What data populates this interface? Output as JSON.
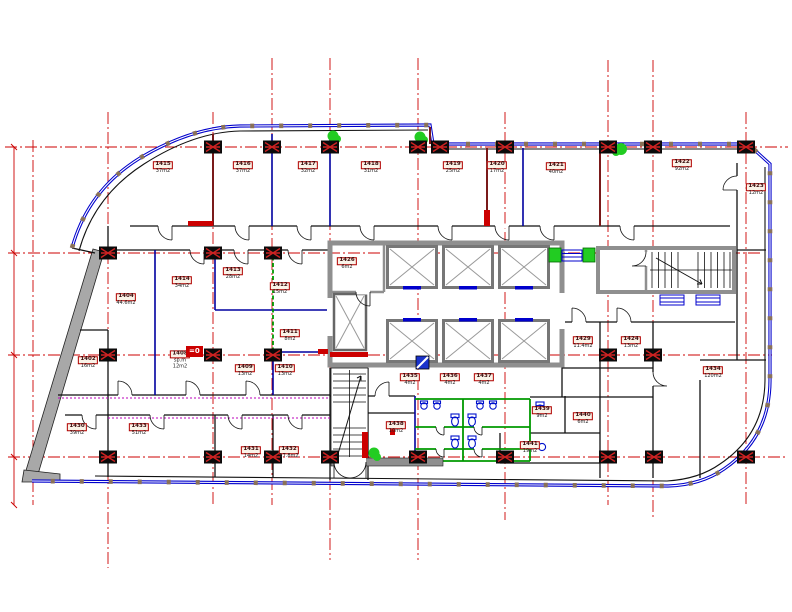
{
  "drawing": {
    "type": "architectural-floor-plan",
    "colors": {
      "grid_axis": "#cc0000",
      "curtain_wall": "#0000cc",
      "partition_blue": "#0000a0",
      "partition_dark_red": "#7a1a1a",
      "sanitary_green": "#009900",
      "concrete_gray": "#a8a8a8",
      "core_gray": "#8f8f8f",
      "mullion_brown": "#8a7257",
      "fixture_blue": "#0011cc",
      "plant_green": "#22cc22",
      "label_red": "#b00000"
    },
    "level_marker": {
      "text": "=0"
    },
    "dim_labels": [
      {
        "text": "8 400",
        "x": 7,
        "y": 232
      },
      {
        "text": "8 400",
        "x": 7,
        "y": 327
      },
      {
        "text": "8 400",
        "x": 7,
        "y": 437
      },
      {
        "text": "4 050",
        "x": 7,
        "y": 502
      }
    ],
    "rooms": [
      {
        "id": "1415",
        "area": "37m2",
        "x": 163,
        "y": 168
      },
      {
        "id": "1416",
        "area": "37m2",
        "x": 243,
        "y": 168
      },
      {
        "id": "1417",
        "area": "32m2",
        "x": 308,
        "y": 168
      },
      {
        "id": "1418",
        "area": "31m2",
        "x": 371,
        "y": 168
      },
      {
        "id": "1419",
        "area": "25m2",
        "x": 453,
        "y": 168
      },
      {
        "id": "1420",
        "area": "17m2",
        "x": 497,
        "y": 168
      },
      {
        "id": "1421",
        "area": "40m2",
        "x": 556,
        "y": 169
      },
      {
        "id": "1422",
        "area": "92m2",
        "x": 682,
        "y": 166
      },
      {
        "id": "1423",
        "area": "12m2",
        "x": 756,
        "y": 190
      },
      {
        "id": "1404",
        "area": "44.6m2",
        "x": 126,
        "y": 300
      },
      {
        "id": "1414",
        "area": "34m2",
        "x": 182,
        "y": 283
      },
      {
        "id": "1413",
        "area": "28m2",
        "x": 233,
        "y": 274
      },
      {
        "id": "1412",
        "area": "15m2",
        "x": 280,
        "y": 289
      },
      {
        "id": "1411",
        "area": "8m2",
        "x": 290,
        "y": 336
      },
      {
        "id": "1402",
        "area": "16m2",
        "x": 88,
        "y": 363
      },
      {
        "id": "1408",
        "sub": "sp.m",
        "area": "12m2",
        "x": 180,
        "y": 360
      },
      {
        "id": "1409",
        "area": "13m2",
        "x": 245,
        "y": 371
      },
      {
        "id": "1410",
        "area": "13m2",
        "x": 285,
        "y": 371
      },
      {
        "id": "1426",
        "area": "6m2",
        "x": 347,
        "y": 264
      },
      {
        "id": "1435",
        "area": "4m2",
        "x": 410,
        "y": 380
      },
      {
        "id": "1436",
        "area": "4m2",
        "x": 450,
        "y": 380
      },
      {
        "id": "1437",
        "area": "4m2",
        "x": 484,
        "y": 380
      },
      {
        "id": "1438",
        "area": "10m2",
        "x": 396,
        "y": 428
      },
      {
        "id": "1439",
        "area": "9m2",
        "x": 542,
        "y": 413
      },
      {
        "id": "1440",
        "area": "6m2",
        "x": 583,
        "y": 419
      },
      {
        "id": "1441",
        "area": "19m2",
        "x": 530,
        "y": 448
      },
      {
        "id": "1430",
        "area": "39m2",
        "x": 77,
        "y": 430
      },
      {
        "id": "1433",
        "area": "51m2",
        "x": 139,
        "y": 430
      },
      {
        "id": "1431",
        "area": "14m2",
        "x": 251,
        "y": 453
      },
      {
        "id": "1432",
        "area": "17.8m2",
        "x": 289,
        "y": 453
      },
      {
        "id": "1429",
        "area": "11.4m2",
        "x": 583,
        "y": 343
      },
      {
        "id": "1424",
        "area": "13m2",
        "x": 631,
        "y": 343
      },
      {
        "id": "1434",
        "area": "120m2",
        "x": 713,
        "y": 373
      }
    ]
  }
}
